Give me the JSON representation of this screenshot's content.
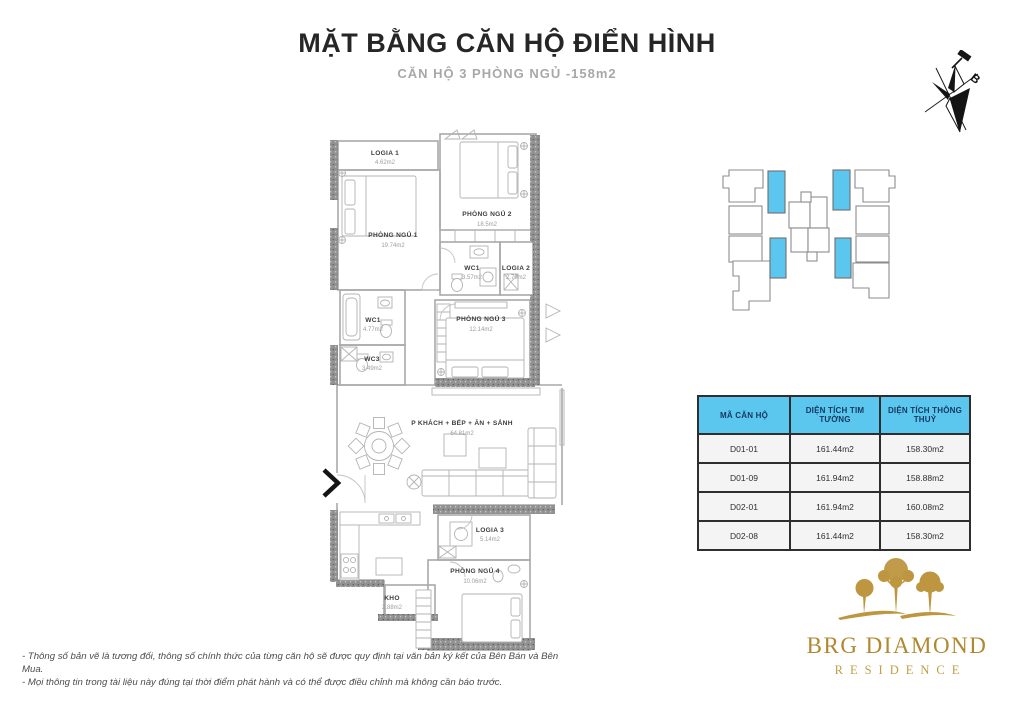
{
  "header": {
    "title": "MẶT BẰNG CĂN HỘ ĐIỂN HÌNH",
    "subtitle": "CĂN HỘ 3 PHÒNG NGỦ -158m2"
  },
  "compass": {
    "direction_label": "B"
  },
  "key_plan": {
    "highlight_color": "#5cc7ee"
  },
  "floor_plan": {
    "rooms": [
      {
        "name": "LOGIA 1",
        "area": "4.62m2"
      },
      {
        "name": "PHÒNG NGỦ 1",
        "area": "19.74m2"
      },
      {
        "name": "PHÒNG NGỦ 2",
        "area": "18.5m2"
      },
      {
        "name": "WC1",
        "area": "3.57m2"
      },
      {
        "name": "LOGIA 2",
        "area": "2.79m2"
      },
      {
        "name": "WC1",
        "area": "4.77m2"
      },
      {
        "name": "WC3",
        "area": "3.49m2"
      },
      {
        "name": "PHÒNG NGỦ 3",
        "area": "12.14m2"
      },
      {
        "name": "P KHÁCH + BẾP + ĂN + SẢNH",
        "area": "64.81m2"
      },
      {
        "name": "LOGIA 3",
        "area": "5.14m2"
      },
      {
        "name": "KHO",
        "area": "2.88m2"
      },
      {
        "name": "PHÒNG NGỦ 4",
        "area": "10.06m2"
      }
    ]
  },
  "table": {
    "headers": [
      "MÃ CĂN HỘ",
      "DIỆN TÍCH TIM TƯỜNG",
      "DIỆN TÍCH THÔNG THUỶ"
    ],
    "rows": [
      [
        "D01-01",
        "161.44m2",
        "158.30m2"
      ],
      [
        "D01-09",
        "161.94m2",
        "158.88m2"
      ],
      [
        "D02-01",
        "161.94m2",
        "160.08m2"
      ],
      [
        "D02-08",
        "161.44m2",
        "158.30m2"
      ]
    ],
    "header_bg": "#5cc7ee",
    "header_text_color": "#14375f"
  },
  "logo": {
    "brand": "BRG DIAMOND",
    "sub_brand": "RESIDENCE",
    "gold_color": "#b08830"
  },
  "notes": {
    "line1": "- Thông số bản vẽ là tương đối, thông số chính thức của từng căn hộ sẽ được quy định tại văn bản ký kết của Bên Bán và Bên Mua.",
    "line2": "- Mọi thông tin trong tài liệu này đúng tại thời điểm phát hành và có thể được điều chỉnh mà không cần báo trước."
  }
}
